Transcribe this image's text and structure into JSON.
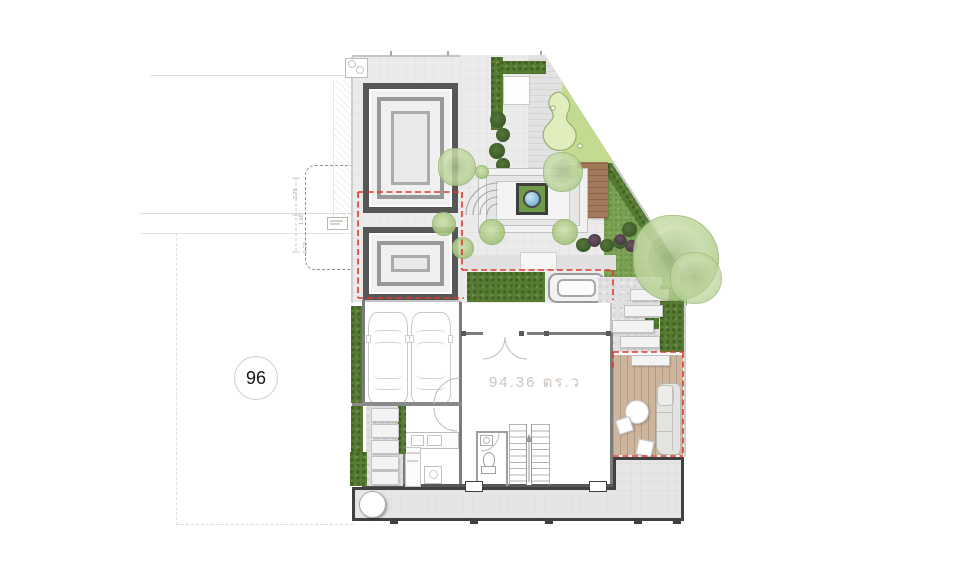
{
  "plan": {
    "lot_number": "96",
    "area_label": "94.36 ตร.ว",
    "dimension_labels": [
      "2.75",
      "1.00",
      "0.70"
    ],
    "colors": {
      "boundary_red": "#e2372c",
      "hedge_green": "#567c31",
      "lawn_green": "#7ba152",
      "putting_green": "#c3db90",
      "putting_kidney": "#e0edbc",
      "wood_deck": "#a2795a",
      "patio_deck": "#cdb49c",
      "water_blue": "#84b9d8",
      "paving_gray": "#ebebeb",
      "wall_gray": "#7c7c7c"
    }
  }
}
